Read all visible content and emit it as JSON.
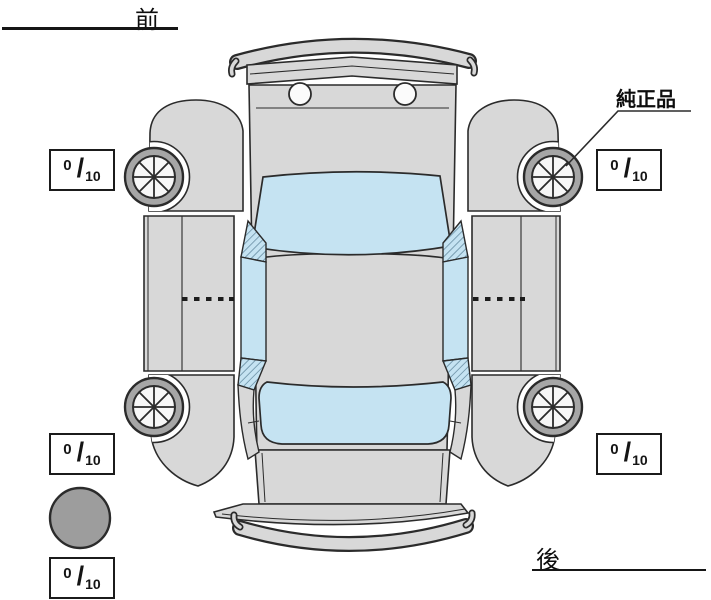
{
  "labels": {
    "front": "前",
    "rear": "後",
    "genuine_part": "純正品"
  },
  "tread": {
    "separator": "/",
    "front_left": {
      "value": "0",
      "max": "10"
    },
    "front_right": {
      "value": "0",
      "max": "10"
    },
    "rear_left": {
      "value": "0",
      "max": "10"
    },
    "rear_right": {
      "value": "0",
      "max": "10"
    },
    "spare": {
      "value": "0",
      "max": "10"
    }
  },
  "colors": {
    "body": "#d8d8d8",
    "glass": "#c5e3f2",
    "tire": "#a6a6a6",
    "spare_tire": "#9d9d9d",
    "outline": "#2b2b2b"
  }
}
